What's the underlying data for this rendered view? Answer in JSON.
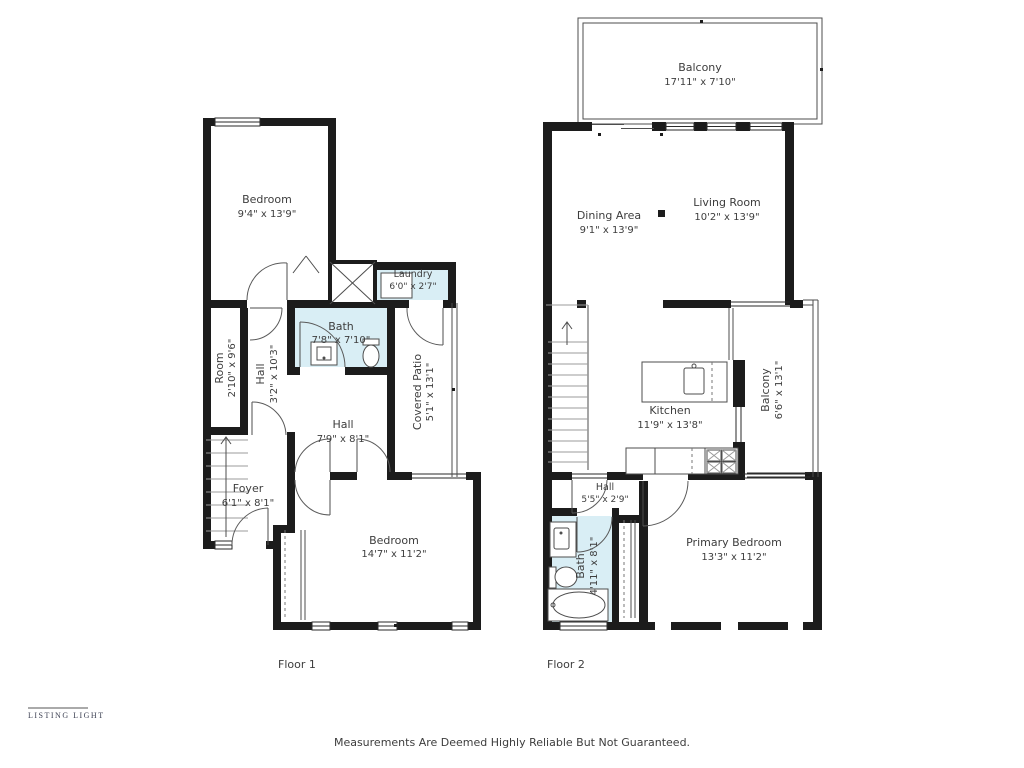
{
  "colors": {
    "background": "#ffffff",
    "wall": "#1c1c1c",
    "wet_room_fill": "#d9eef5",
    "thin_line": "#4d4d4d",
    "label_text": "#3d3d3d"
  },
  "floor1": {
    "label": "Floor 1",
    "rooms": {
      "bedroom_top": {
        "name": "Bedroom",
        "dims": "9'4\" x 13'9\""
      },
      "laundry": {
        "name": "Laundry",
        "dims": "6'0\" x 2'7\""
      },
      "bath": {
        "name": "Bath",
        "dims": "7'8\" x 7'10\""
      },
      "room": {
        "name": "Room",
        "dims": "2'10\" x 9'6\""
      },
      "hall_upper": {
        "name": "Hall",
        "dims": "3'2\" x 10'3\""
      },
      "covered_patio": {
        "name": "Covered Patio",
        "dims": "5'1\" x 13'1\""
      },
      "hall_lower": {
        "name": "Hall",
        "dims": "7'9\" x 8'1\""
      },
      "foyer": {
        "name": "Foyer",
        "dims": "6'1\" x 8'1\""
      },
      "bedroom_bottom": {
        "name": "Bedroom",
        "dims": "14'7\" x 11'2\""
      }
    }
  },
  "floor2": {
    "label": "Floor 2",
    "rooms": {
      "balcony_top": {
        "name": "Balcony",
        "dims": "17'11\" x 7'10\""
      },
      "dining": {
        "name": "Dining Area",
        "dims": "9'1\" x 13'9\""
      },
      "living": {
        "name": "Living Room",
        "dims": "10'2\" x 13'9\""
      },
      "kitchen": {
        "name": "Kitchen",
        "dims": "11'9\" x 13'8\""
      },
      "balcony_right": {
        "name": "Balcony",
        "dims": "6'6\" x 13'1\""
      },
      "hall": {
        "name": "Hall",
        "dims": "5'5\" x 2'9\""
      },
      "bath": {
        "name": "Bath",
        "dims": "4'11\" x 8'1\""
      },
      "primary_bedroom": {
        "name": "Primary Bedroom",
        "dims": "13'3\" x 11'2\""
      }
    }
  },
  "footer": {
    "logo": "LISTING LIGHT",
    "disclaimer": "Measurements Are Deemed Highly Reliable But Not Guaranteed."
  }
}
